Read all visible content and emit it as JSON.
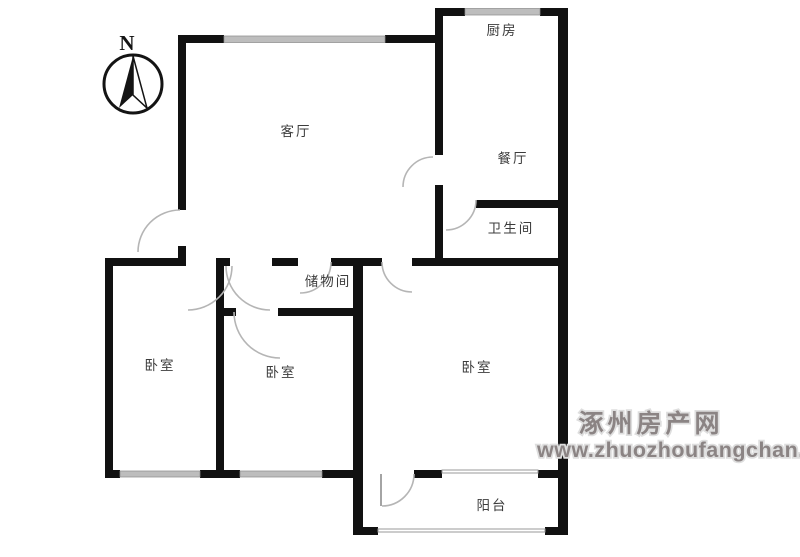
{
  "compass": {
    "label": "N"
  },
  "rooms": {
    "kitchen": {
      "label": "厨房"
    },
    "living_room": {
      "label": "客厅"
    },
    "dining_room": {
      "label": "餐厅"
    },
    "bathroom": {
      "label": "卫生间"
    },
    "storage_room": {
      "label": "储物间"
    },
    "bedroom_left": {
      "label": "卧室"
    },
    "bedroom_middle": {
      "label": "卧室"
    },
    "bedroom_right": {
      "label": "卧室"
    },
    "balcony": {
      "label": "阳台"
    }
  },
  "watermark": {
    "site_name": "涿州房产网",
    "url": "www.zhuozhoufangchan.com",
    "text_color": "#8b8484",
    "halo_color": "#dedede"
  },
  "palette": {
    "wall": "#111111",
    "window_band": "#bdbdbd",
    "door_arc": "#b5b5b5",
    "label_text": "#3c3c3c",
    "background": "#ffffff"
  }
}
